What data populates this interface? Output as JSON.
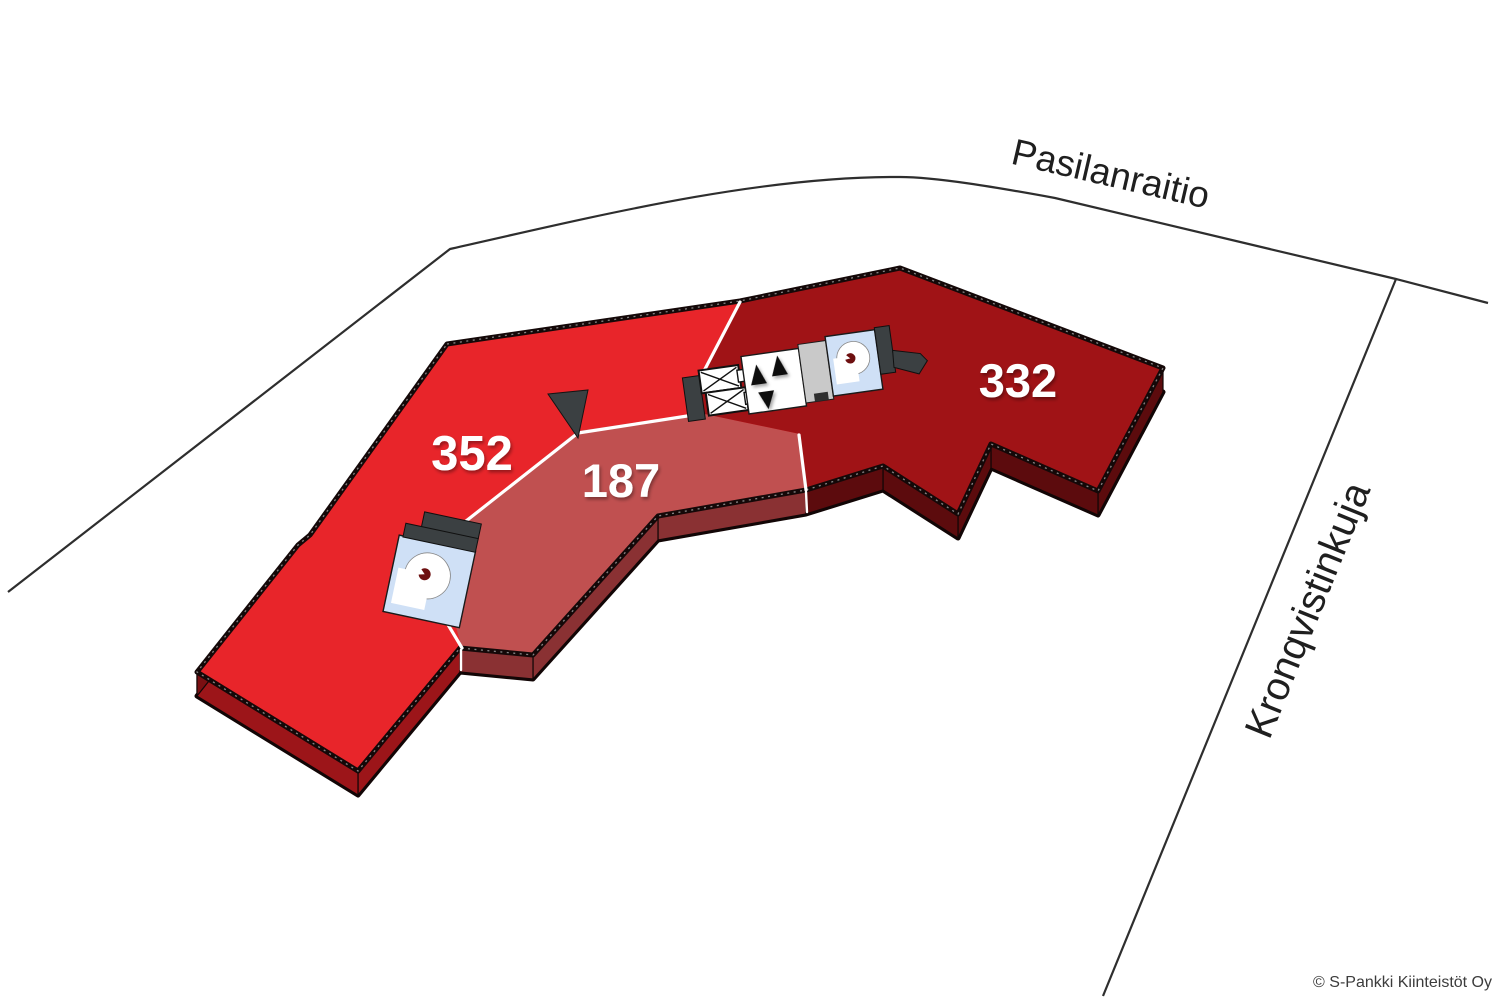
{
  "title": "Floor plan site diagram",
  "streets": {
    "top": {
      "label": "Pasilanraitio"
    },
    "right": {
      "label": "Kronqvistinkuja"
    }
  },
  "sections": [
    {
      "id": "352",
      "label": "352",
      "color": "#e8252a",
      "side_color": "#9c1519"
    },
    {
      "id": "187",
      "label": "187",
      "color": "#c05050",
      "side_color": "#8a3133"
    },
    {
      "id": "332",
      "label": "332",
      "color": "#a01316",
      "side_color": "#5c0b0d"
    }
  ],
  "building": {
    "outline_color": "#140808",
    "base_color": "#4c0808",
    "west_side_color": "#7a0f12",
    "divider_color": "#ffffff",
    "wall_color": "#3b4042",
    "core_icons": [
      "elevator-icon",
      "elevator-icon",
      "escalator-arrows-icon",
      "service-block",
      "spiral-staircase-icon"
    ],
    "stairwell_icon": "spiral-staircase-icon"
  },
  "canvas": {
    "background": "#ffffff",
    "street_line_color": "#2e2e2e"
  },
  "footer": {
    "copyright": "© S-Pankki Kiinteistöt Oy"
  }
}
